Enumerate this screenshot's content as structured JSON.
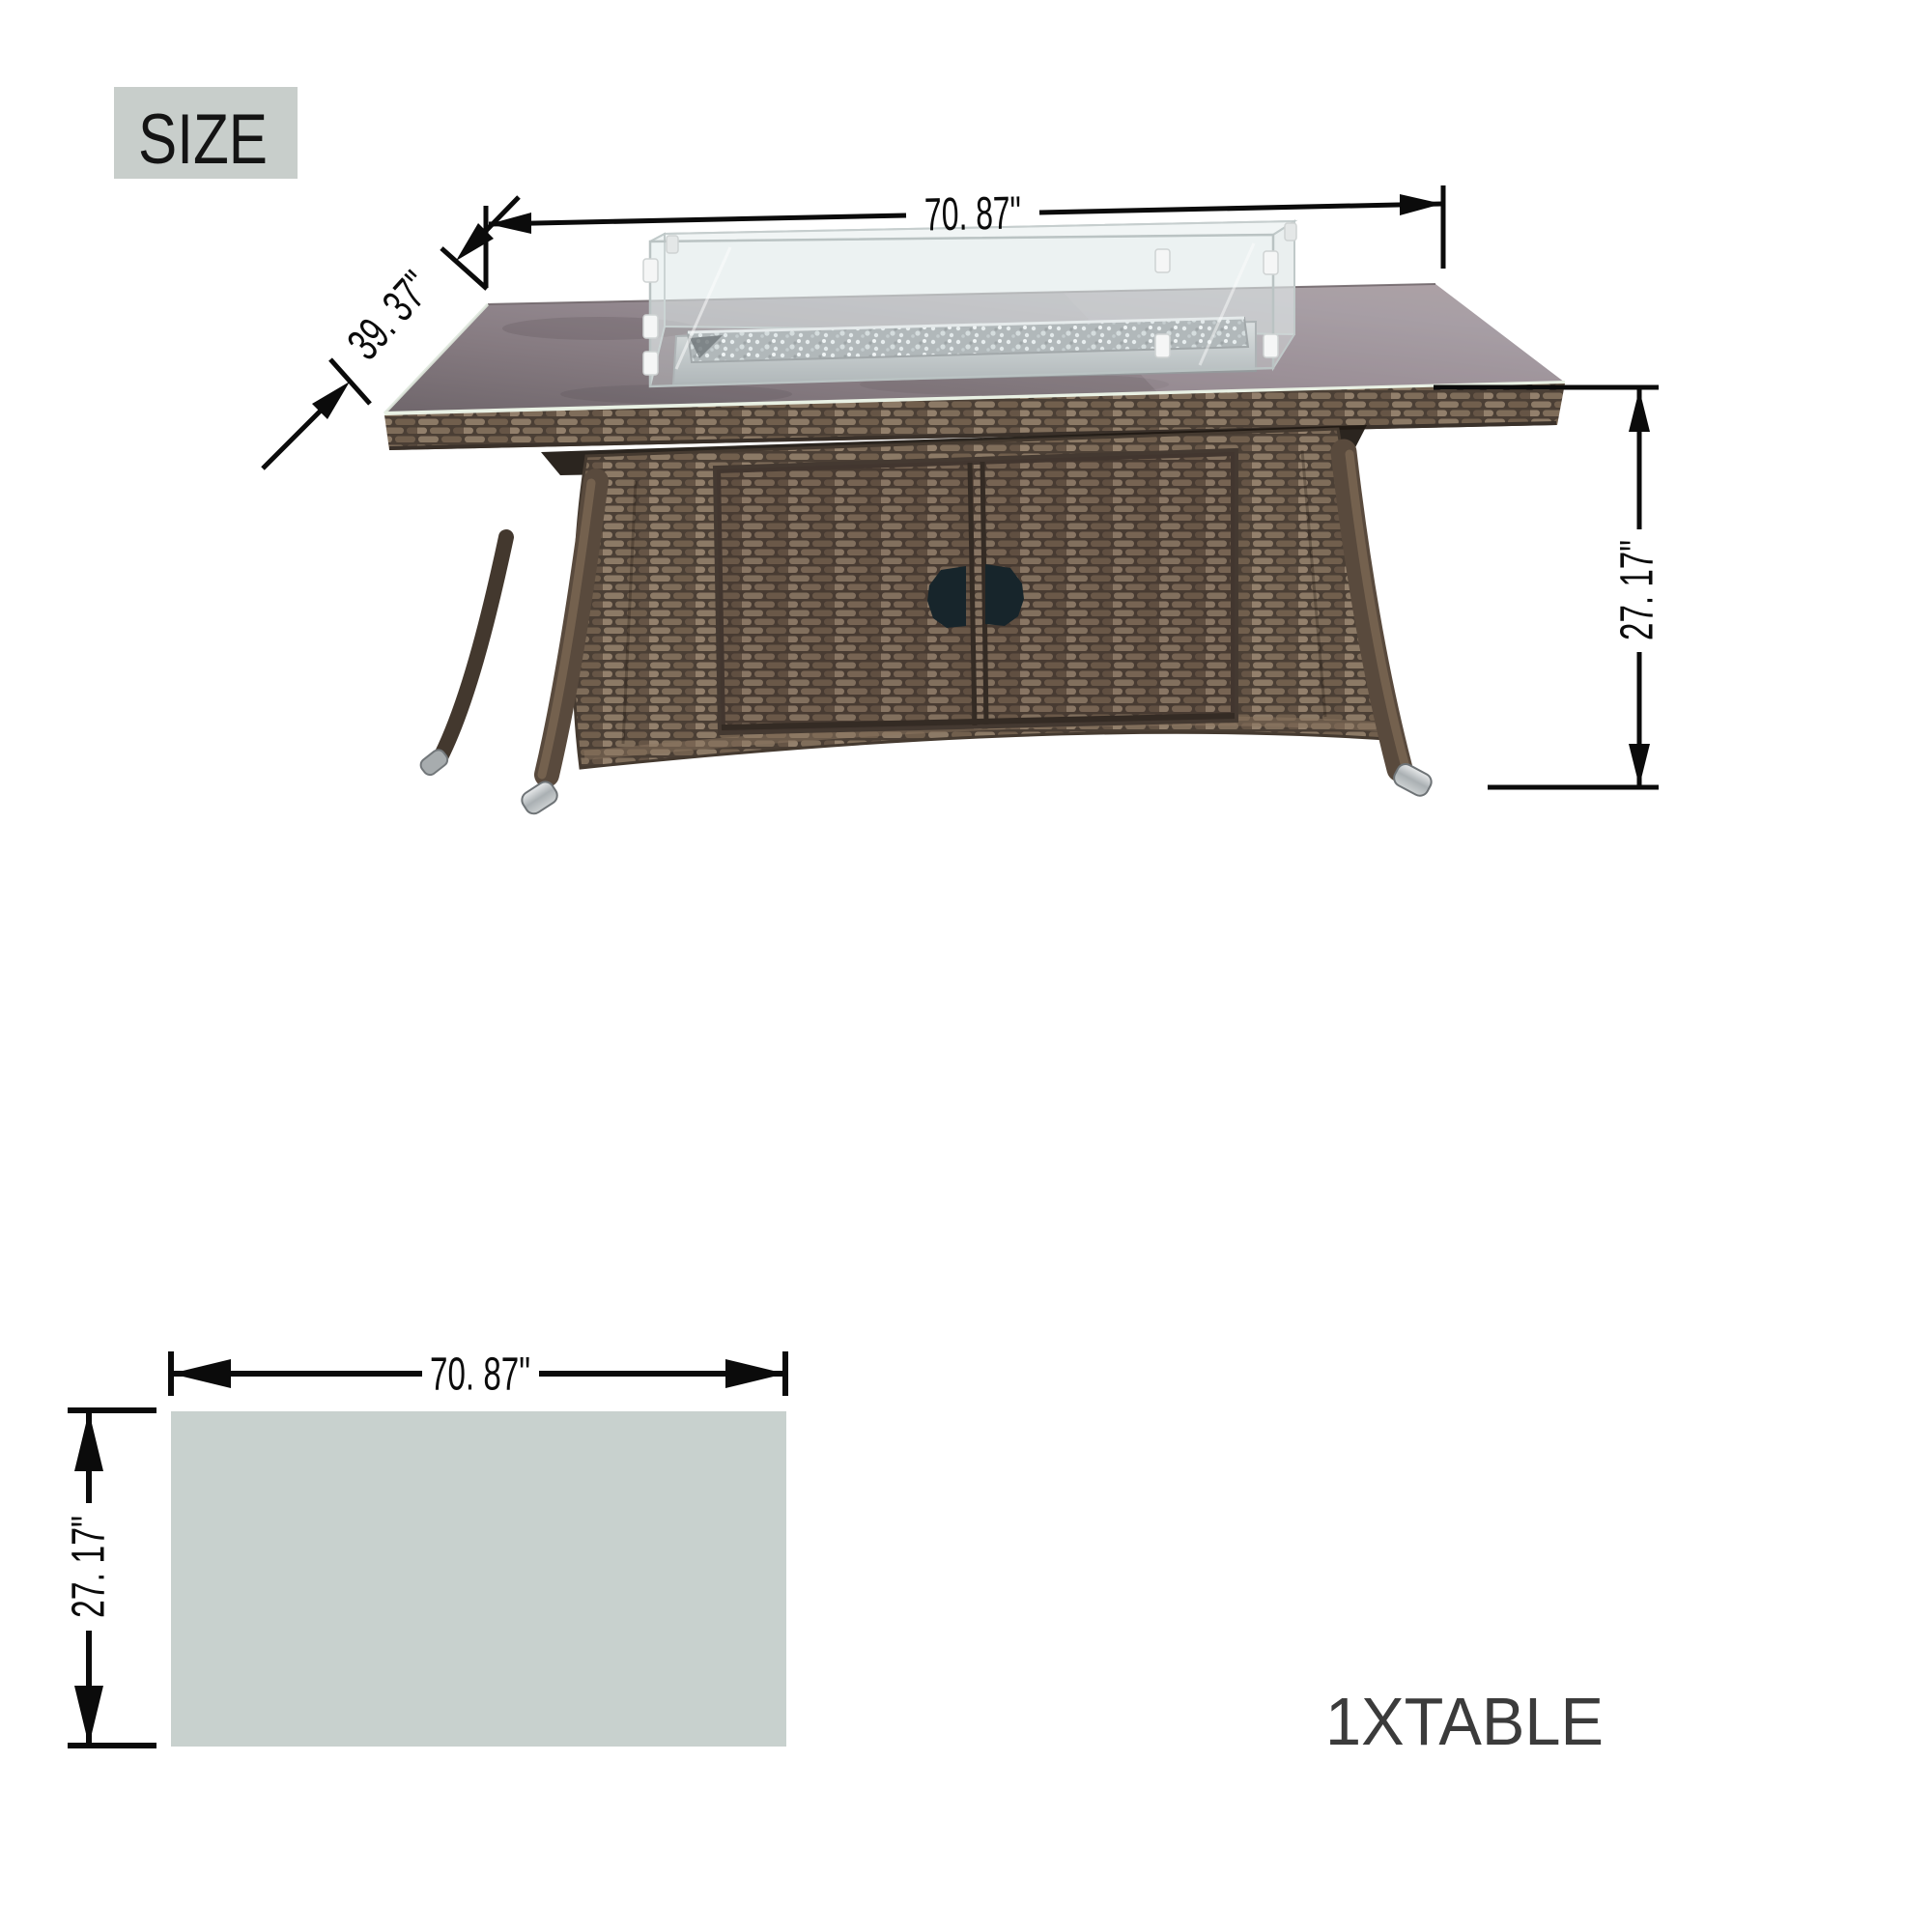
{
  "size_badge": {
    "label": "SIZE"
  },
  "table_diagram": {
    "width_label": "70. 87\"",
    "depth_label": "39. 37\"",
    "height_label": "27. 17\""
  },
  "footprint": {
    "width_label": "70. 87\"",
    "height_label": "27. 17\""
  },
  "caption": {
    "label": "1XTABLE"
  },
  "measurements": {
    "width": "70.87",
    "depth": "39.37",
    "height": "27.17",
    "unit": "inches"
  },
  "colors": {
    "size_badge_bg": "#c8cecb",
    "footprint_fill": "#c8d1ce",
    "caption_text": "#3b3b3b",
    "dimension_ink": "#0b0b0b",
    "wicker_mid": "#6d5b48",
    "glass_top_tint": "#8e838a",
    "leg_cap_silver": "#b9bec0",
    "handle_cutout": "#17252b"
  }
}
